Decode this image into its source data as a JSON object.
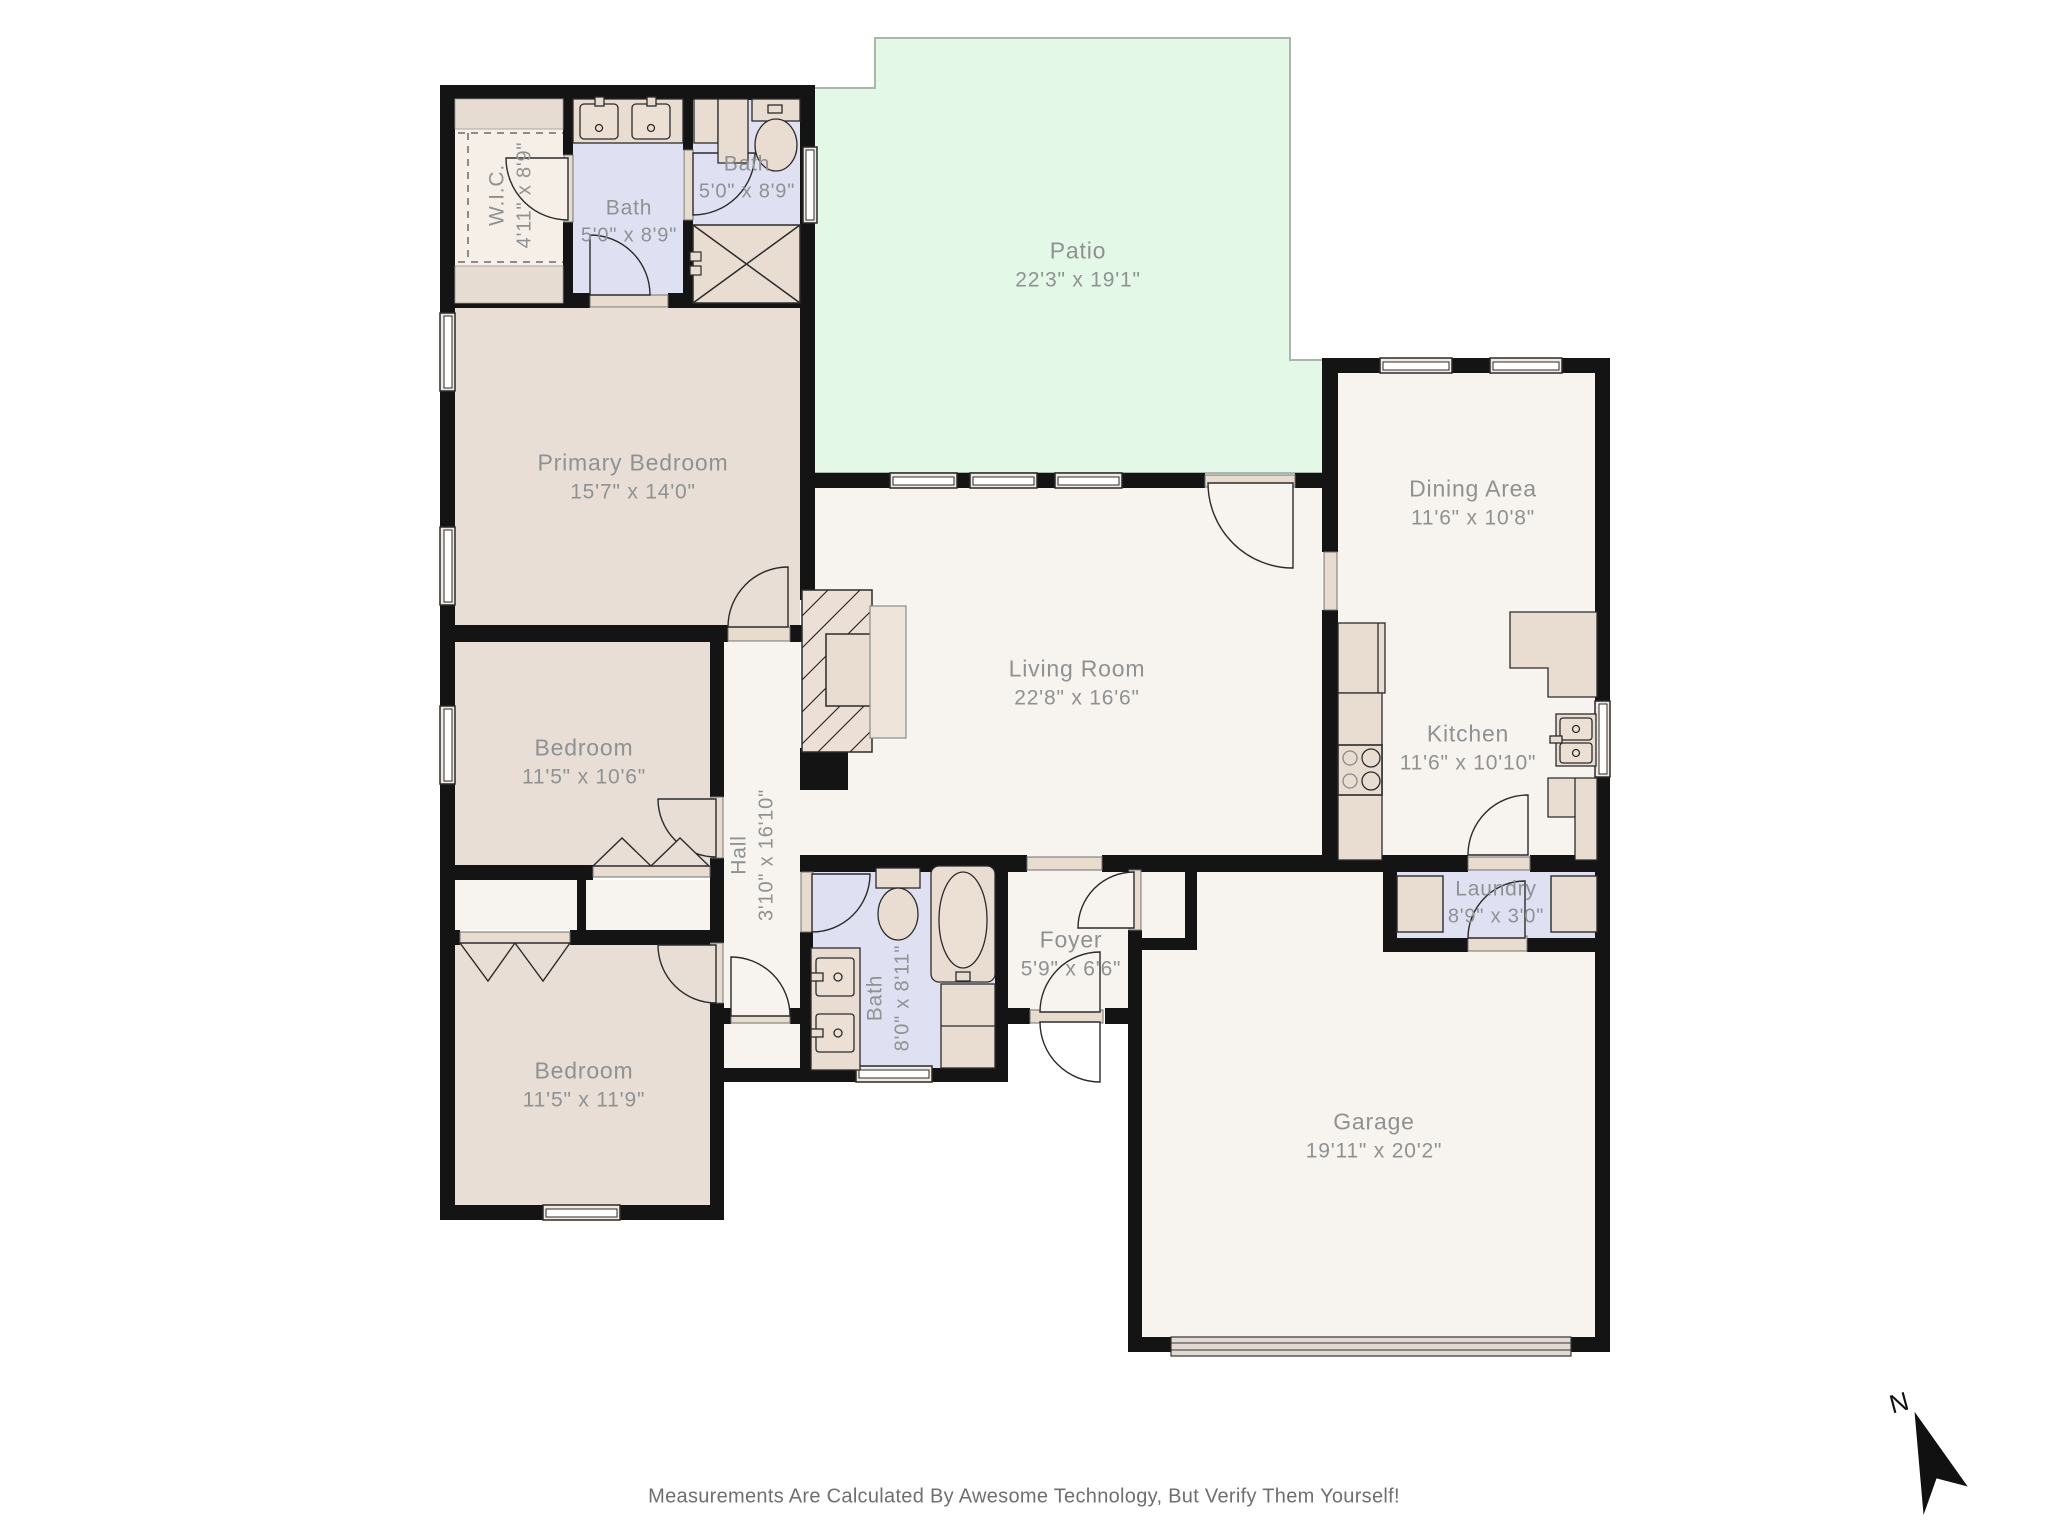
{
  "footer": {
    "text": "Measurements Are Calculated By Awesome Technology, But Verify Them Yourself!"
  },
  "compass": {
    "label": "N"
  },
  "palette": {
    "wall": "#141414",
    "bedroom_floor": "#e8ded6",
    "common_floor": "#f7f3ef",
    "bath_floor": "#dfe1f3",
    "patio_green": "#e4f8e7",
    "fixture_tan": "#e9ddd1",
    "label_gray": "#8e9292"
  },
  "rooms": [
    {
      "id": "wic",
      "name": "W.I.C.",
      "dims": "4'11\" x 8'9\""
    },
    {
      "id": "bath-top-center",
      "name": "Bath",
      "dims": "5'0\" x 8'9\""
    },
    {
      "id": "bath-top-right",
      "name": "Bath",
      "dims": "5'0\" x 8'9\""
    },
    {
      "id": "patio",
      "name": "Patio",
      "dims": "22'3\" x 19'1\""
    },
    {
      "id": "primary-bedroom",
      "name": "Primary Bedroom",
      "dims": "15'7\" x 14'0\""
    },
    {
      "id": "dining-area",
      "name": "Dining Area",
      "dims": "11'6\" x 10'8\""
    },
    {
      "id": "living-room",
      "name": "Living Room",
      "dims": "22'8\" x 16'6\""
    },
    {
      "id": "kitchen",
      "name": "Kitchen",
      "dims": "11'6\" x 10'10\""
    },
    {
      "id": "bedroom-middle",
      "name": "Bedroom",
      "dims": "11'5\" x 10'6\""
    },
    {
      "id": "hall",
      "name": "Hall",
      "dims": "3'10\" x 16'10\""
    },
    {
      "id": "bath-hall",
      "name": "Bath",
      "dims": "8'0\" x 8'11\""
    },
    {
      "id": "foyer",
      "name": "Foyer",
      "dims": "5'9\" x 6'6\""
    },
    {
      "id": "laundry",
      "name": "Laundry",
      "dims": "8'9\" x 3'0\""
    },
    {
      "id": "bedroom-lower",
      "name": "Bedroom",
      "dims": "11'5\" x 11'9\""
    },
    {
      "id": "garage",
      "name": "Garage",
      "dims": "19'11\" x 20'2\""
    }
  ]
}
